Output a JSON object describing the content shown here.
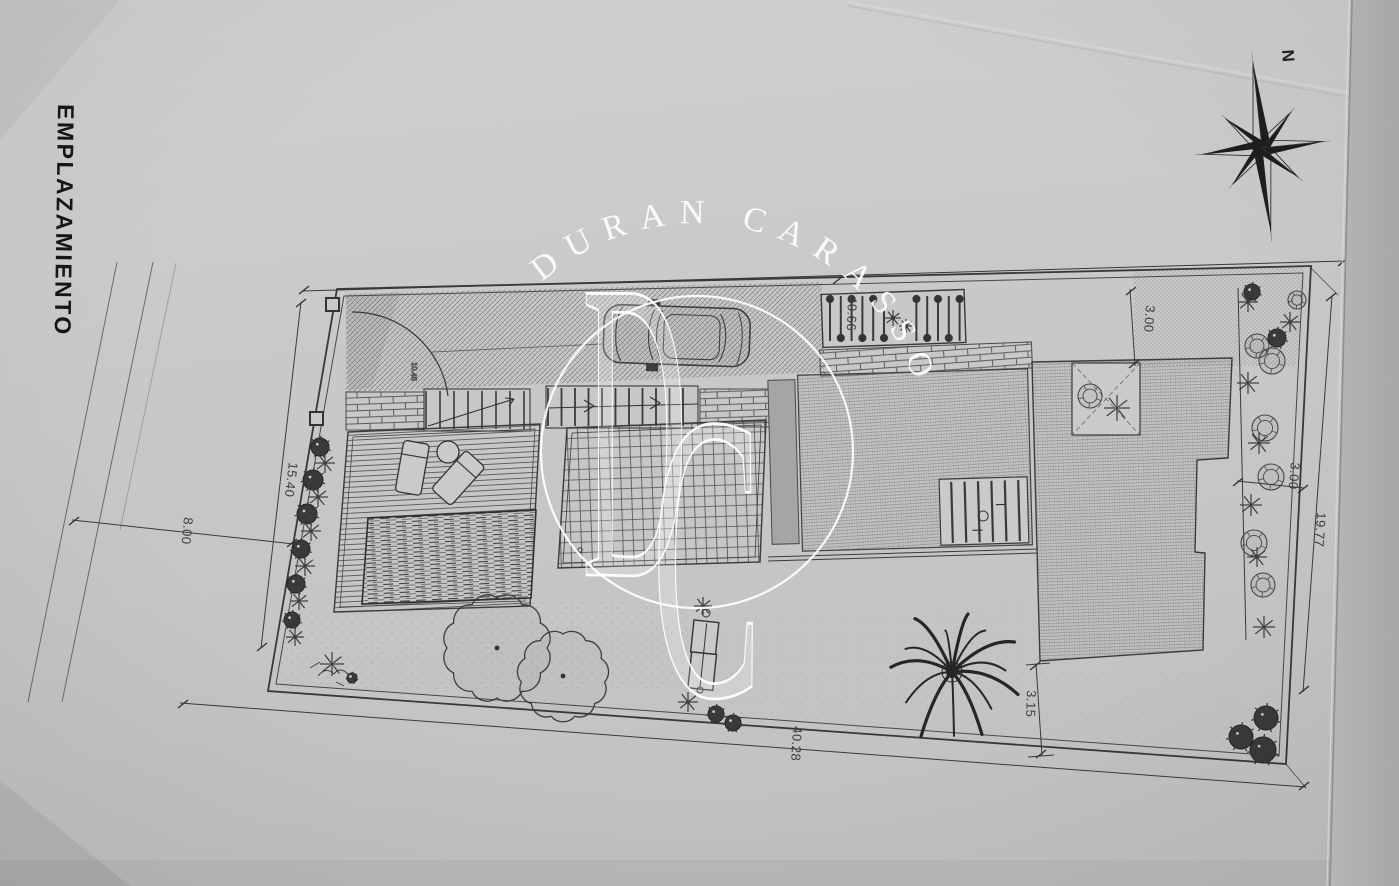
{
  "title": {
    "text": "EMPLAZAMIENTO"
  },
  "compass": {
    "north_label": "N"
  },
  "watermark": {
    "arc_text": "DURAN CARASSO",
    "monogram_d": "D",
    "monogram_c": "C"
  },
  "dimensions": {
    "top_boundary": "40.66",
    "setback_top_right": "3.00",
    "left_upper": "15.40",
    "street_left": "8.00",
    "right_boundary": "19.77",
    "bottom_boundary": "40.28",
    "setback_bottom_right": "3.15",
    "garden_right": "3.00",
    "entry_level": "10.45"
  },
  "colors": {
    "paper": "#c9c8c6",
    "ink": "#3a3a3a",
    "watermark": "#ffffff"
  }
}
